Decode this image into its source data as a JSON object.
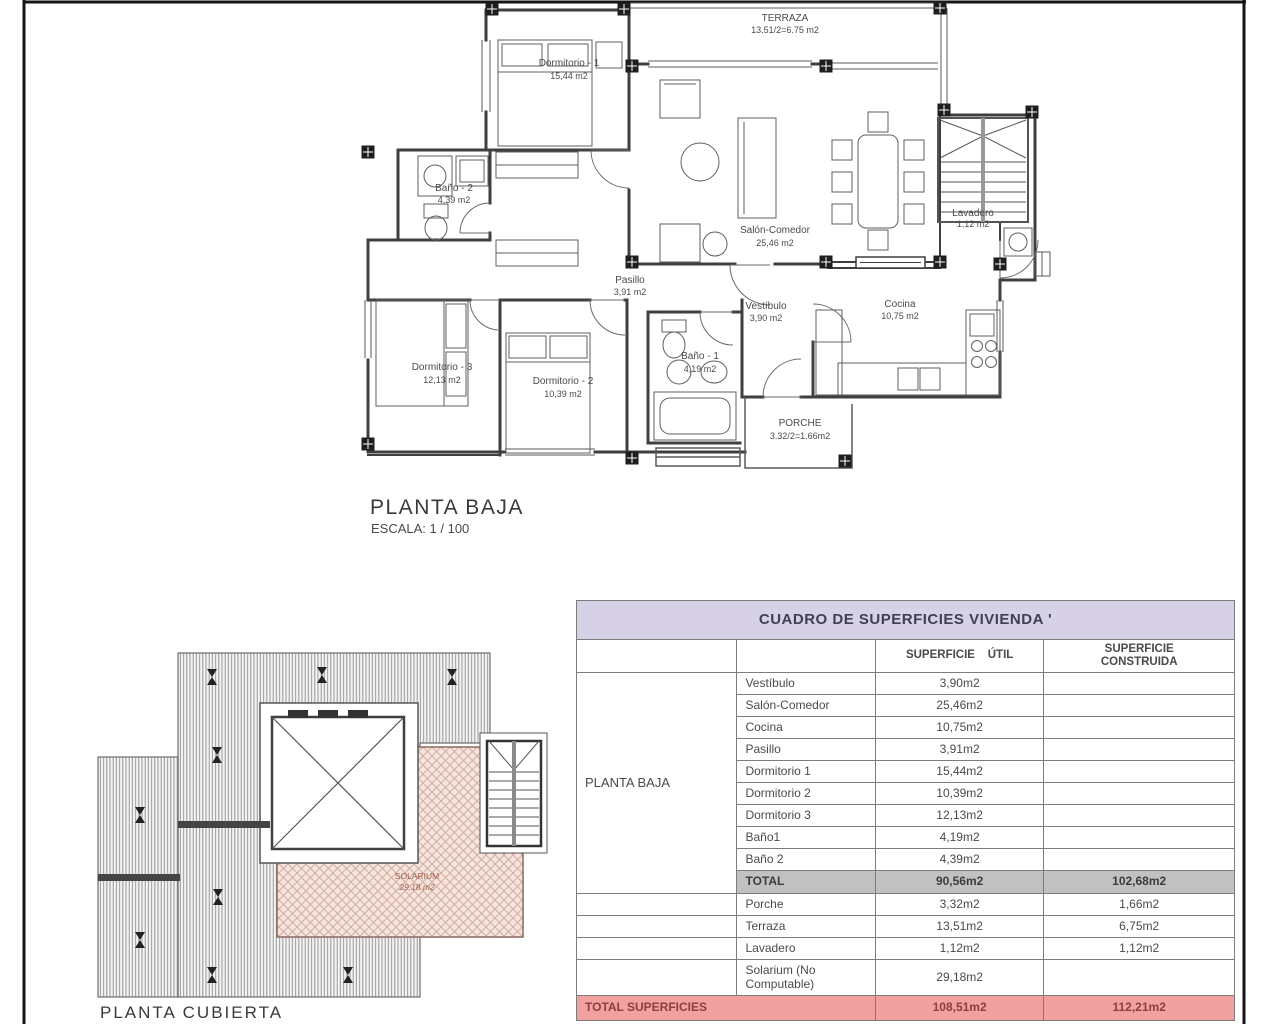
{
  "floor_plan": {
    "title": "PLANTA BAJA",
    "scale": "ESCALA: 1 / 100",
    "terraza": {
      "name": "TERRAZA",
      "area": "13.51/2=6.75 m2"
    },
    "dormitorio1": {
      "name": "Dormitorio - 1",
      "area": "15,44 m2"
    },
    "bano2": {
      "name": "Baño - 2",
      "area": "4,39 m2"
    },
    "salon": {
      "name": "Salón-Comedor",
      "area": "25,46 m2"
    },
    "lavadero": {
      "name": "Lavadero",
      "area": "1,12 m2"
    },
    "pasillo": {
      "name": "Pasillo",
      "area": "3,91 m2"
    },
    "vestibulo": {
      "name": "Vestíbulo",
      "area": "3,90 m2"
    },
    "cocina": {
      "name": "Cocina",
      "area": "10,75 m2"
    },
    "dormitorio3": {
      "name": "Dormitorio - 3",
      "area": "12,13 m2"
    },
    "dormitorio2": {
      "name": "Dormitorio - 2",
      "area": "10,39 m2"
    },
    "bano1": {
      "name": "Baño - 1",
      "area": "4,19 m2"
    },
    "porche": {
      "name": "PORCHE",
      "area": "3.32/2=1.66m2"
    }
  },
  "roof_plan": {
    "title": "PLANTA CUBIERTA",
    "solarium_name": "SOLARIUM",
    "solarium_area": "29,18 m2"
  },
  "table": {
    "title": "CUADRO DE SUPERFICIES  VIVIENDA '",
    "col_util": "SUPERFICIE    ÚTIL",
    "col_built": "SUPERFICIE\nCONSTRUIDA",
    "group_label": "PLANTA BAJA",
    "rooms": [
      {
        "name": "Vestíbulo",
        "util": "3,90m2",
        "built": ""
      },
      {
        "name": "Salón-Comedor",
        "util": "25,46m2",
        "built": ""
      },
      {
        "name": "Cocina",
        "util": "10,75m2",
        "built": ""
      },
      {
        "name": "Pasillo",
        "util": "3,91m2",
        "built": ""
      },
      {
        "name": "Dormitorio 1",
        "util": "15,44m2",
        "built": ""
      },
      {
        "name": "Dormitorio 2",
        "util": "10,39m2",
        "built": ""
      },
      {
        "name": "Dormitorio 3",
        "util": "12,13m2",
        "built": ""
      },
      {
        "name": "Baño1",
        "util": "4,19m2",
        "built": ""
      },
      {
        "name": "Baño 2",
        "util": "4,39m2",
        "built": ""
      }
    ],
    "total": {
      "label": "TOTAL",
      "util": "90,56m2",
      "built": "102,68m2"
    },
    "extras": [
      {
        "name": "Porche",
        "util": "3,32m2",
        "built": "1,66m2"
      },
      {
        "name": "Terraza",
        "util": "13,51m2",
        "built": "6,75m2"
      },
      {
        "name": "Lavadero",
        "util": "1,12m2",
        "built": "1,12m2"
      },
      {
        "name": "Solarium (No Computable)",
        "util": "29,18m2",
        "built": ""
      }
    ],
    "grand": {
      "label": "TOTAL SUPERFICIES",
      "util": "108,51m2",
      "built": "112,21m2"
    }
  },
  "colors": {
    "table_title_bg": "#d6d1e7",
    "total_row_bg": "#c2c1c1",
    "grand_row_bg": "#f2a1a1",
    "solarium_fill": "#f5e5de",
    "wall_line": "#3f3f3f"
  }
}
